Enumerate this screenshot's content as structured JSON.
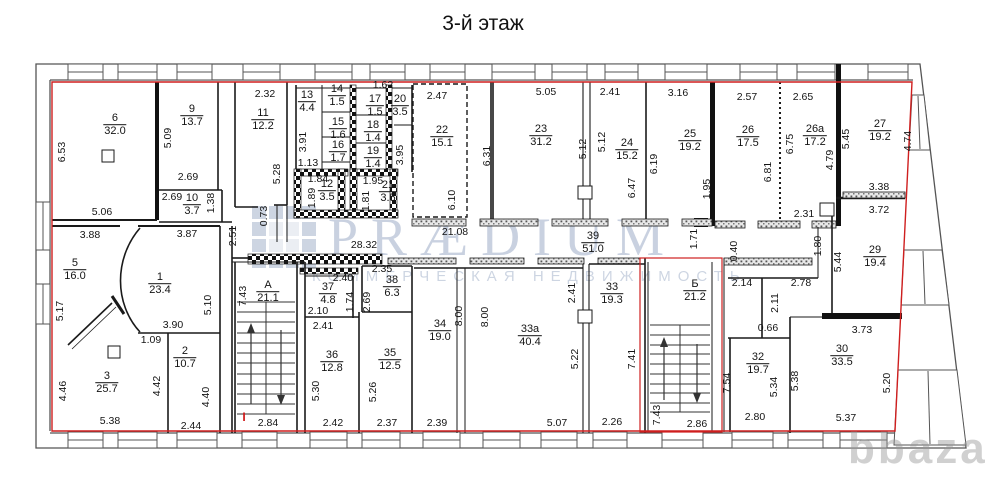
{
  "title": "3-й этаж",
  "watermark": {
    "brand": "PRÆDIUM",
    "subtitle": "КОММЕРЧЕСКАЯ НЕДВИЖИМОСТЬ",
    "corner_logo": "bbaza",
    "brand_color": "#5a73a0",
    "corner_color": "#969696"
  },
  "colors": {
    "boundary_red": "#cf1f1f",
    "wall_black": "#141414",
    "outline_gray": "#555555"
  },
  "plan": {
    "rooms": [
      [
        "6",
        "32.0",
        115,
        125
      ],
      [
        "9",
        "13.7",
        192,
        116
      ],
      [
        "10",
        "3.7",
        192,
        205
      ],
      [
        "11",
        "12.2",
        263,
        120
      ],
      [
        "13",
        "4.4",
        307,
        102
      ],
      [
        "14",
        "1.5",
        337,
        96
      ],
      [
        "15",
        "1.6",
        338,
        129
      ],
      [
        "16",
        "1.7",
        338,
        152
      ],
      [
        "17",
        "1.5",
        375,
        106
      ],
      [
        "18",
        "1.4",
        373,
        132
      ],
      [
        "19",
        "1.4",
        373,
        158
      ],
      [
        "20",
        "3.5",
        400,
        106
      ],
      [
        "12",
        "3.5",
        327,
        191
      ],
      [
        "21",
        "3.5",
        388,
        192
      ],
      [
        "22",
        "15.1",
        442,
        137
      ],
      [
        "23",
        "31.2",
        541,
        136
      ],
      [
        "24",
        "15.2",
        627,
        150
      ],
      [
        "25",
        "19.2",
        690,
        141
      ],
      [
        "26",
        "17.5",
        748,
        137
      ],
      [
        "26а",
        "17.2",
        815,
        136
      ],
      [
        "27",
        "19.2",
        880,
        131
      ],
      [
        "29",
        "19.4",
        875,
        257
      ],
      [
        "30",
        "33.5",
        842,
        356
      ],
      [
        "32",
        "19.7",
        758,
        364
      ],
      [
        "5",
        "16.0",
        75,
        270
      ],
      [
        "1",
        "23.4",
        160,
        284
      ],
      [
        "3",
        "25.7",
        107,
        383
      ],
      [
        "2",
        "10.7",
        185,
        358
      ],
      [
        "А",
        "21.1",
        268,
        292
      ],
      [
        "37",
        "4.8",
        328,
        294
      ],
      [
        "38",
        "6.3",
        392,
        287
      ],
      [
        "36",
        "12.8",
        332,
        362
      ],
      [
        "35",
        "12.5",
        390,
        360
      ],
      [
        "34",
        "19.0",
        440,
        331
      ],
      [
        "33а",
        "40.4",
        530,
        336
      ],
      [
        "33",
        "19.3",
        612,
        294
      ],
      [
        "39",
        "51.0",
        593,
        243
      ],
      [
        "Б",
        "21.2",
        695,
        291
      ]
    ],
    "dims": [
      [
        "6.53",
        62,
        152,
        1
      ],
      [
        "5.09",
        168,
        138,
        1
      ],
      [
        "2.69",
        188,
        177,
        0
      ],
      [
        "2.69",
        172,
        197,
        0
      ],
      [
        "1.38",
        211,
        203,
        1
      ],
      [
        "5.06",
        102,
        212,
        0
      ],
      [
        "3.88",
        90,
        235,
        0
      ],
      [
        "3.87",
        187,
        234,
        0
      ],
      [
        "2.51",
        233,
        236,
        1
      ],
      [
        "2.32",
        265,
        94,
        0
      ],
      [
        "5.28",
        277,
        174,
        1
      ],
      [
        "0.73",
        264,
        216,
        1
      ],
      [
        "3.91",
        303,
        142,
        1
      ],
      [
        "1.13",
        308,
        163,
        0
      ],
      [
        "1.84",
        318,
        179,
        0
      ],
      [
        "1.89",
        312,
        198,
        1
      ],
      [
        "1.62",
        383,
        85,
        0
      ],
      [
        "1.95",
        373,
        181,
        0
      ],
      [
        "1.81",
        366,
        201,
        1
      ],
      [
        "3.95",
        400,
        155,
        1
      ],
      [
        "2.47",
        437,
        96,
        0
      ],
      [
        "6.10",
        452,
        200,
        1
      ],
      [
        "6.31",
        487,
        156,
        1
      ],
      [
        "5.05",
        546,
        92,
        0
      ],
      [
        "5.12",
        583,
        149,
        1
      ],
      [
        "5.12",
        602,
        142,
        1
      ],
      [
        "2.41",
        610,
        92,
        0
      ],
      [
        "6.47",
        632,
        188,
        1
      ],
      [
        "6.19",
        654,
        164,
        1
      ],
      [
        "3.16",
        678,
        93,
        0
      ],
      [
        "1.95",
        707,
        189,
        1
      ],
      [
        "2.57",
        747,
        97,
        0
      ],
      [
        "6.81",
        768,
        172,
        1
      ],
      [
        "2.65",
        803,
        97,
        0
      ],
      [
        "6.75",
        790,
        144,
        1
      ],
      [
        "4.79",
        830,
        160,
        1
      ],
      [
        "5.45",
        846,
        139,
        1
      ],
      [
        "4.74",
        908,
        141,
        1
      ],
      [
        "3.38",
        879,
        187,
        0
      ],
      [
        "3.72",
        879,
        210,
        0
      ],
      [
        "2.31",
        804,
        214,
        0
      ],
      [
        "1.80",
        818,
        246,
        1
      ],
      [
        "5.44",
        838,
        262,
        1
      ],
      [
        "1.71",
        694,
        239,
        1
      ],
      [
        "0.40",
        734,
        251,
        1
      ],
      [
        "2.14",
        742,
        283,
        0
      ],
      [
        "2.78",
        801,
        283,
        0
      ],
      [
        "2.11",
        775,
        303,
        1
      ],
      [
        "0.66",
        768,
        328,
        0
      ],
      [
        "3.73",
        862,
        330,
        0
      ],
      [
        "7.54",
        727,
        383,
        1
      ],
      [
        "5.34",
        774,
        387,
        1
      ],
      [
        "5.38",
        795,
        381,
        1
      ],
      [
        "5.20",
        887,
        383,
        1
      ],
      [
        "2.80",
        755,
        417,
        0
      ],
      [
        "5.37",
        846,
        418,
        0
      ],
      [
        "5.17",
        60,
        311,
        1
      ],
      [
        "5.10",
        208,
        305,
        1
      ],
      [
        "3.90",
        173,
        325,
        0
      ],
      [
        "1.09",
        151,
        340,
        0
      ],
      [
        "4.46",
        63,
        391,
        1
      ],
      [
        "4.42",
        157,
        386,
        1
      ],
      [
        "4.40",
        206,
        397,
        1
      ],
      [
        "5.38",
        110,
        421,
        0
      ],
      [
        "2.44",
        191,
        426,
        0
      ],
      [
        "2.84",
        268,
        423,
        0
      ],
      [
        "7.43",
        243,
        296,
        1
      ],
      [
        "28.32",
        364,
        245,
        0
      ],
      [
        "21.08",
        455,
        232,
        0
      ],
      [
        "2.40",
        343,
        278,
        0
      ],
      [
        "2.10",
        318,
        311,
        0
      ],
      [
        "1.74",
        350,
        302,
        1
      ],
      [
        "2.69",
        367,
        302,
        1
      ],
      [
        "2.35",
        382,
        269,
        0
      ],
      [
        "2.41",
        323,
        326,
        0
      ],
      [
        "5.30",
        316,
        391,
        1
      ],
      [
        "2.42",
        333,
        423,
        0
      ],
      [
        "5.26",
        373,
        392,
        1
      ],
      [
        "2.37",
        387,
        423,
        0
      ],
      [
        "8.00",
        459,
        316,
        1
      ],
      [
        "8.00",
        485,
        317,
        1
      ],
      [
        "2.39",
        437,
        423,
        0
      ],
      [
        "5.22",
        575,
        359,
        1
      ],
      [
        "5.07",
        557,
        423,
        0
      ],
      [
        "2.41",
        572,
        293,
        1
      ],
      [
        "7.41",
        632,
        359,
        1
      ],
      [
        "2.26",
        612,
        422,
        0
      ],
      [
        "7.43",
        657,
        415,
        1
      ],
      [
        "2.86",
        697,
        424,
        0
      ]
    ],
    "marks": [
      [
        "I",
        244,
        417
      ]
    ]
  }
}
